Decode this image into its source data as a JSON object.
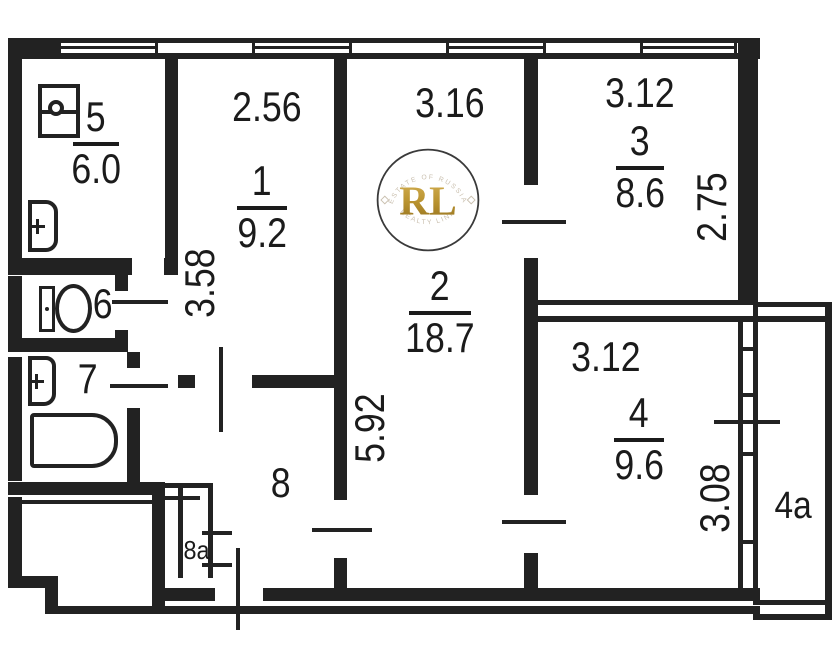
{
  "rooms": {
    "r1": {
      "number": "1",
      "area": "9.2"
    },
    "r2": {
      "number": "2",
      "area": "18.7"
    },
    "r3": {
      "number": "3",
      "area": "8.6"
    },
    "r4": {
      "number": "4",
      "area": "9.6"
    },
    "r5": {
      "number": "5",
      "area": "6.0"
    },
    "r6": {
      "number": "6"
    },
    "r7": {
      "number": "7"
    },
    "r8": {
      "number": "8"
    },
    "r8a": {
      "number": "8a"
    },
    "r4a": {
      "number": "4a"
    }
  },
  "dimensions": {
    "room1_width": "2.56",
    "room2_width": "3.16",
    "room3_width": "3.12",
    "room4_width": "3.12",
    "room1_depth": "3.58",
    "room2_depth": "5.92",
    "room3_depth": "2.75",
    "room4_depth": "3.08"
  },
  "watermark": {
    "initials": "RL",
    "arc_top": "ESTATE OF RUSSIA",
    "arc_bottom": "REALTY LINK"
  },
  "colors": {
    "line": "#222222",
    "watermark_gold": "#b8922f",
    "watermark_arc": "#c9bfae"
  }
}
